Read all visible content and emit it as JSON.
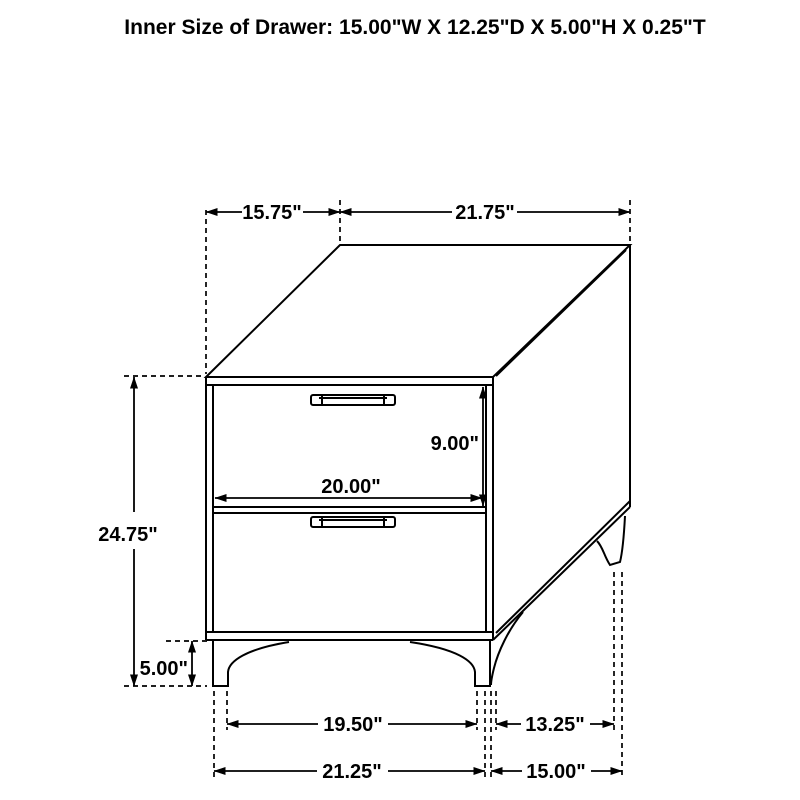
{
  "title": "Inner Size of Drawer: 15.00\"W X 12.25\"D X 5.00\"H X 0.25\"T",
  "dimensions": {
    "top_depth": "15.75\"",
    "top_width": "21.75\"",
    "overall_height": "24.75\"",
    "leg_height": "5.00\"",
    "drawer_face_height": "9.00\"",
    "drawer_front_width": "20.00\"",
    "front_feet_inner_span": "19.50\"",
    "side_feet_inner_span": "13.25\"",
    "front_feet_outer_span": "21.25\"",
    "side_feet_outer_span": "15.00\""
  },
  "colors": {
    "line": "#000000",
    "background": "#ffffff",
    "text": "#000000"
  }
}
